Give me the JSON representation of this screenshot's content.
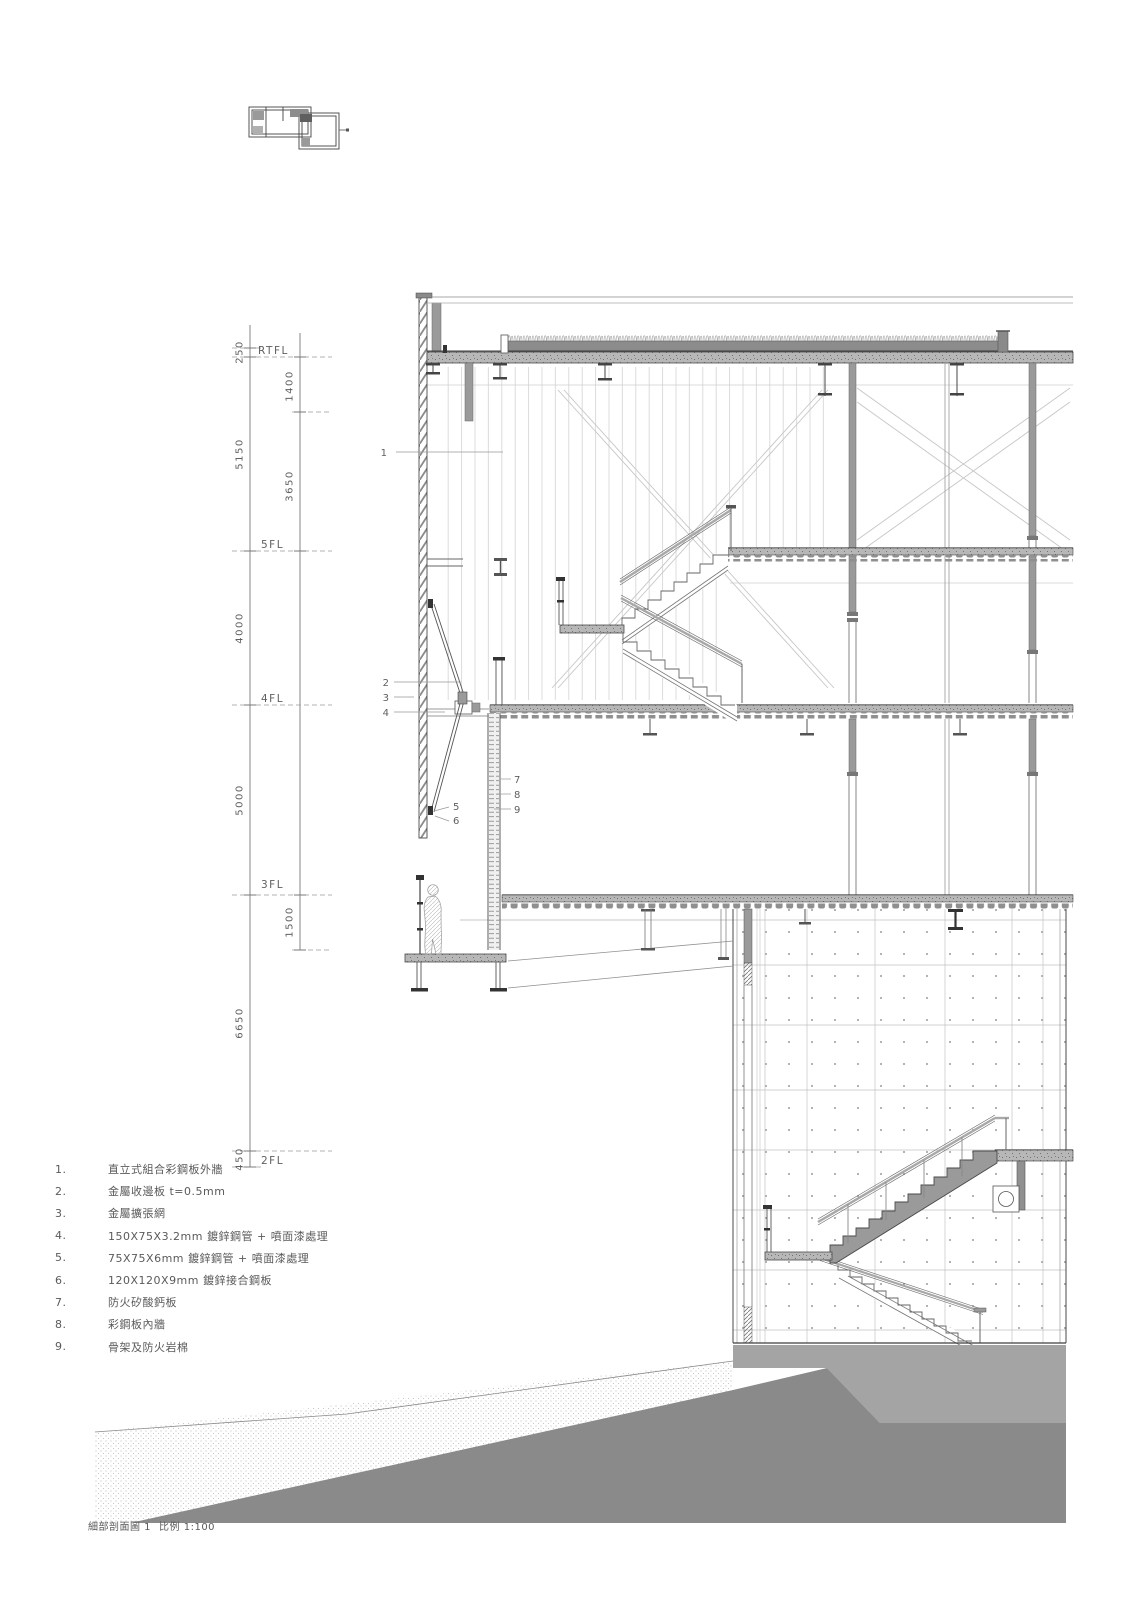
{
  "caption": {
    "name": "細部剖面圖 1",
    "scale": "比例 1:100"
  },
  "drawing": {
    "levels": [
      "RTFL",
      "5FL",
      "4FL",
      "3FL",
      "2FL"
    ],
    "dims_outer": [
      "250",
      "5150",
      "4000",
      "5000",
      "6650",
      "450"
    ],
    "dims_inner": [
      "1400",
      "3650",
      "1500"
    ],
    "callouts": [
      "1",
      "2",
      "3",
      "4",
      "5",
      "6",
      "7",
      "8",
      "9"
    ]
  },
  "legend": {
    "items": [
      {
        "n": "1.",
        "t": "直立式組合彩鋼板外牆"
      },
      {
        "n": "2.",
        "t": "金屬收邊板 t=0.5mm"
      },
      {
        "n": "3.",
        "t": "金屬擴張網"
      },
      {
        "n": "4.",
        "t": "150X75X3.2mm 鍍鋅鋼管 + 噴面漆處理"
      },
      {
        "n": "5.",
        "t": "75X75X6mm 鍍鋅鋼管 + 噴面漆處理"
      },
      {
        "n": "6.",
        "t": "120X120X9mm 鍍鋅接合鋼板"
      },
      {
        "n": "7.",
        "t": "防火矽酸鈣板"
      },
      {
        "n": "8.",
        "t": "彩鋼板內牆"
      },
      {
        "n": "9.",
        "t": "骨架及防火岩棉"
      }
    ]
  },
  "palette": {
    "line": "#555555",
    "faint": "#c8c8c8",
    "steel_gray": "#9a9a9a",
    "slab_gray": "#b7b7b7",
    "ground_dark": "#8a8a8a",
    "ground_light": "#a4a4a4"
  }
}
